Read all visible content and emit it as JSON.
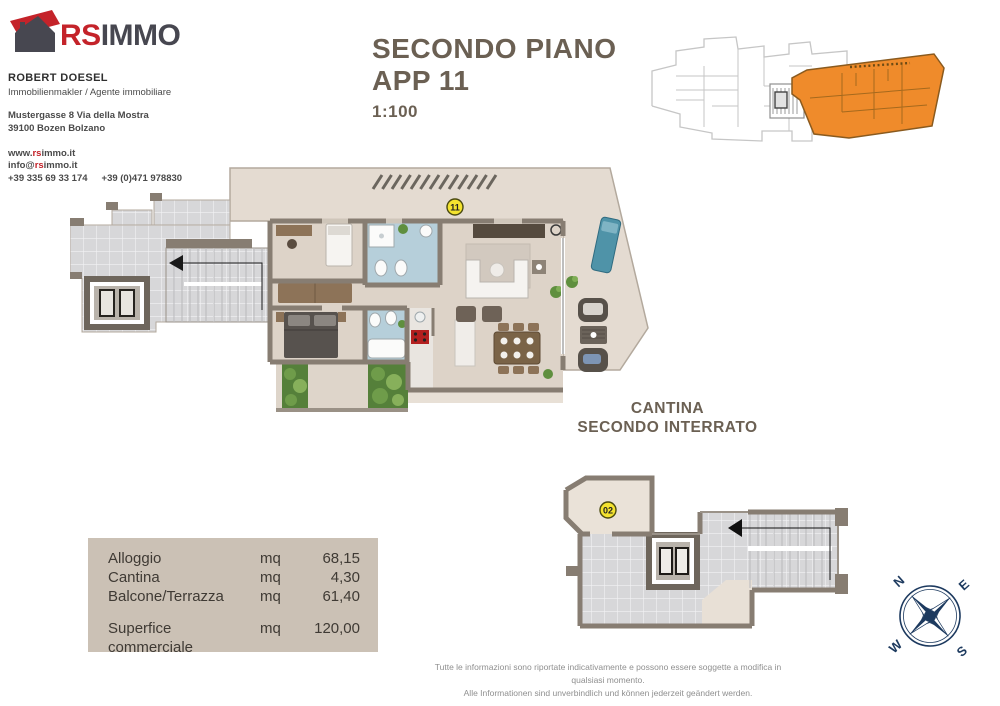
{
  "brand": {
    "rs": "RS",
    "immo": "IMMO"
  },
  "agent": {
    "name": "ROBERT DOESEL",
    "role": "Immobilienmakler / Agente immobiliare",
    "address1": "Mustergasse 8 Via della Mostra",
    "address2": "39100 Bozen Bolzano",
    "web_pre": "www.",
    "web_brand": "rs",
    "web_post": "immo.it",
    "mail_pre": "info@",
    "mail_brand": "rs",
    "mail_post": "immo.it",
    "phone1": "+39 335 69 33 174",
    "phone2": "+39 (0)471 978830"
  },
  "title": {
    "line1": "SECONDO PIANO",
    "line2": "APP 11",
    "scale": "1:100"
  },
  "cantina": {
    "line1": "CANTINA",
    "line2": "SECONDO INTERRATO"
  },
  "badges": {
    "apartment": "11",
    "cantina": "02"
  },
  "areas": {
    "rows": [
      {
        "label": "Alloggio",
        "unit": "mq",
        "value": "68,15"
      },
      {
        "label": "Cantina",
        "unit": "mq",
        "value": "4,30"
      },
      {
        "label": "Balcone/Terrazza",
        "unit": "mq",
        "value": "61,40"
      }
    ],
    "total": {
      "label": "Superfice commerciale",
      "unit": "mq",
      "value": "120,00"
    }
  },
  "compass": {
    "n": "N",
    "e": "E",
    "s": "S",
    "w": "W"
  },
  "footer": {
    "line1": "Tutte le informazioni sono riportate indicativamente e possono essere soggette a modifica in qualsiasi momento.",
    "line2": "Alle Informationen sind unverbindlich und können jederzeit geändert werden."
  },
  "colors": {
    "brand_red": "#c4232a",
    "brand_dark": "#474750",
    "title_taupe": "#6b6053",
    "accent_orange": "#ef8b2b",
    "badge_yellow": "#f4e32f",
    "compass_navy": "#1d3a5f",
    "table_bg": "#cbc1b5",
    "wall": "#877d72"
  }
}
